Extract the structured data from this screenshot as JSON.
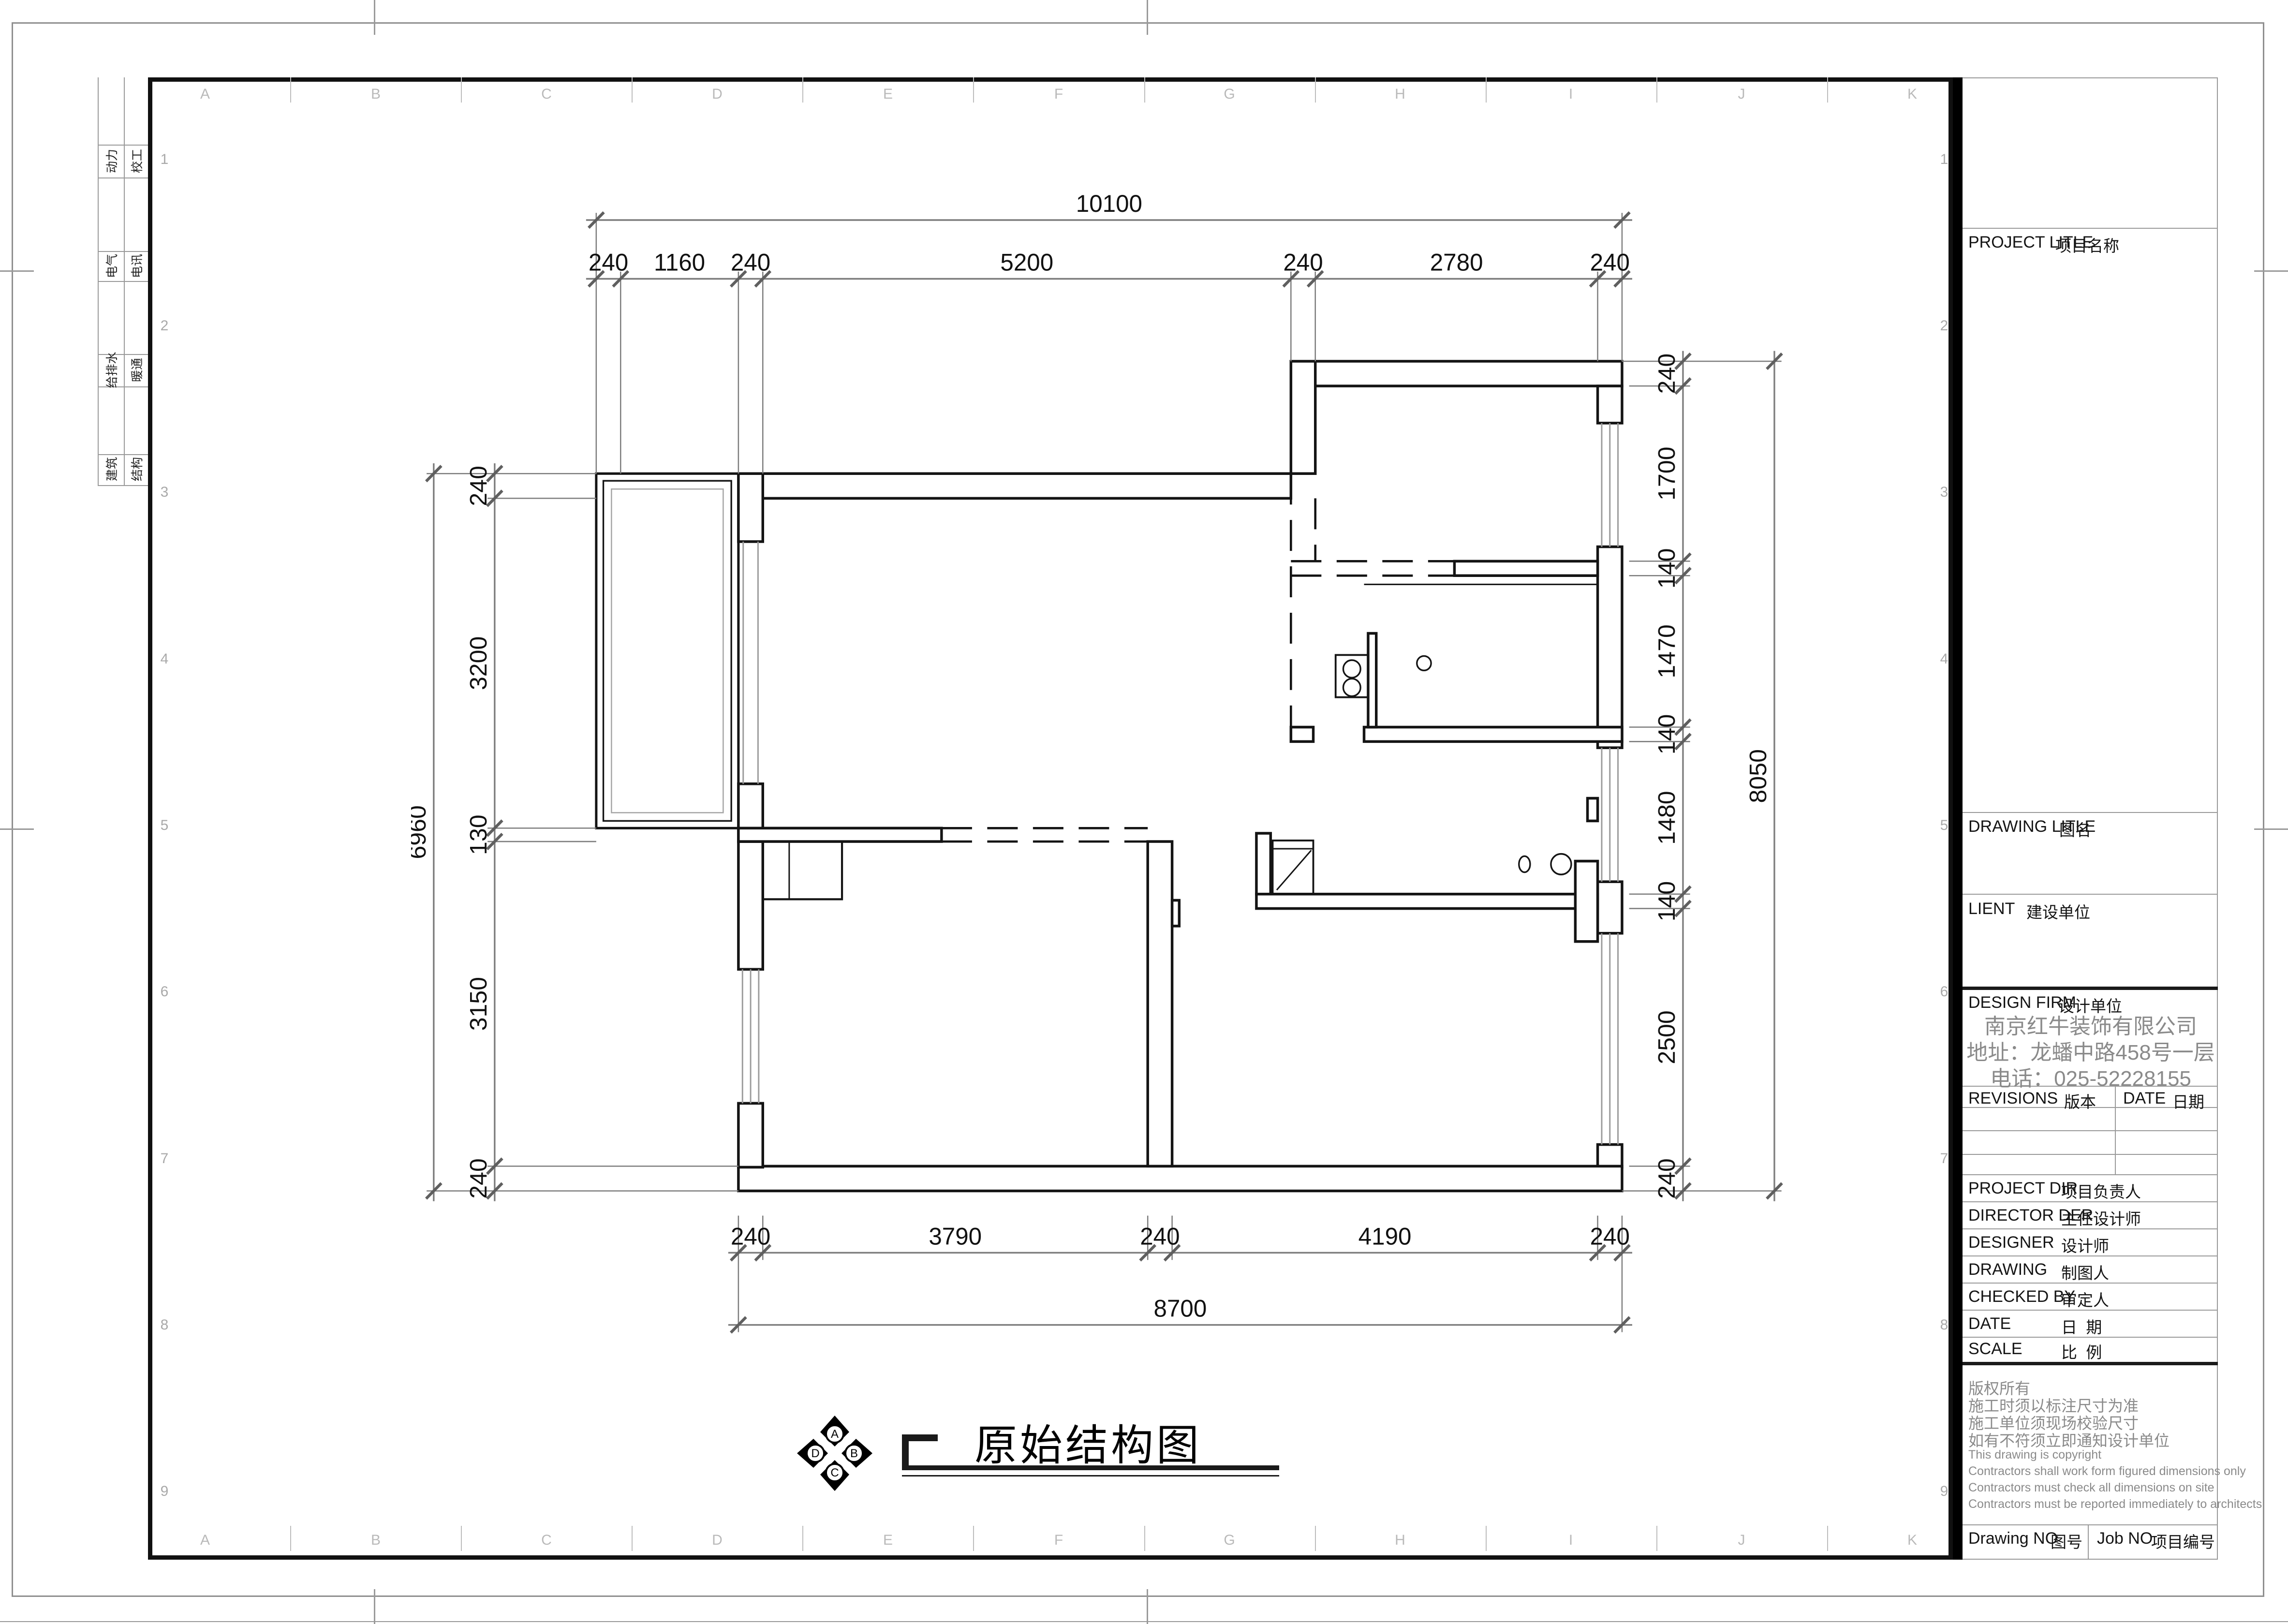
{
  "sheet": {
    "grid_letters": [
      "A",
      "B",
      "C",
      "D",
      "E",
      "F",
      "G",
      "H",
      "I",
      "J",
      "K"
    ],
    "grid_numbers": [
      "1",
      "2",
      "3",
      "4",
      "5",
      "6",
      "7",
      "8",
      "9"
    ],
    "disciplines": [
      {
        "left": "动力",
        "right": "校工"
      },
      {
        "left": "电气",
        "right": "电讯"
      },
      {
        "left": "给排水",
        "right": "暖通"
      },
      {
        "left": "建筑",
        "right": "结构"
      }
    ]
  },
  "plan": {
    "title": "原始结构图",
    "compass": {
      "top": "A",
      "right": "B",
      "bottom": "C",
      "left": "D"
    },
    "dims": {
      "top_overall": "10100",
      "top": [
        "240",
        "1160",
        "240",
        "5200",
        "240",
        "2780",
        "240"
      ],
      "bottom": [
        "240",
        "3790",
        "240",
        "4190",
        "240"
      ],
      "bottom_overall": "8700",
      "left": [
        "240",
        "3200",
        "130",
        "3150",
        "240"
      ],
      "left_overall": "6960",
      "right": [
        "240",
        "1700",
        "140",
        "1470",
        "140",
        "1480",
        "140",
        "2500",
        "240"
      ],
      "right_overall": "8050"
    }
  },
  "title_block": {
    "project": {
      "en": "PROJECT LITLE",
      "cn": "项目名称"
    },
    "drawing_title": {
      "en": "DRAWING LITLE",
      "cn": "图名"
    },
    "client": {
      "en": "LIENT",
      "cn": "建设单位"
    },
    "design_firm": {
      "en": "DESIGN FIRM",
      "cn": "设计单位"
    },
    "firm": {
      "name": "南京红牛装饰有限公司",
      "address": "地址：龙蟠中路458号一层",
      "phone": "电话：025-52228155"
    },
    "revisions": {
      "en": "REVISIONS",
      "cn": "版本"
    },
    "date_col": {
      "en": "DATE",
      "cn": "日期"
    },
    "staff": [
      {
        "en": "PROJECT DIR",
        "cn": "项目负责人"
      },
      {
        "en": "DIRECTOR DER",
        "cn": "主任设计师"
      },
      {
        "en": "DESIGNER",
        "cn": "设计师"
      },
      {
        "en": "DRAWING",
        "cn": "制图人"
      },
      {
        "en": "CHECKED BY",
        "cn": "审定人"
      },
      {
        "en": "DATE",
        "cn": "日  期"
      },
      {
        "en": "SCALE",
        "cn": "比  例"
      }
    ],
    "copyright_cn": [
      "版权所有",
      "施工时须以标注尺寸为准",
      "施工单位须现场校验尺寸",
      "如有不符须立即通知设计单位"
    ],
    "copyright_en": [
      "This drawing is copyright",
      "Contractors shall work form figured dimensions only",
      "Contractors must check all dimensions on site",
      "Contractors must be reported immediately to architects"
    ],
    "drawing_no": {
      "en": "Drawing NO",
      "cn": "图号"
    },
    "job_no": {
      "en": "Job NO",
      "cn": "项目编号"
    }
  }
}
